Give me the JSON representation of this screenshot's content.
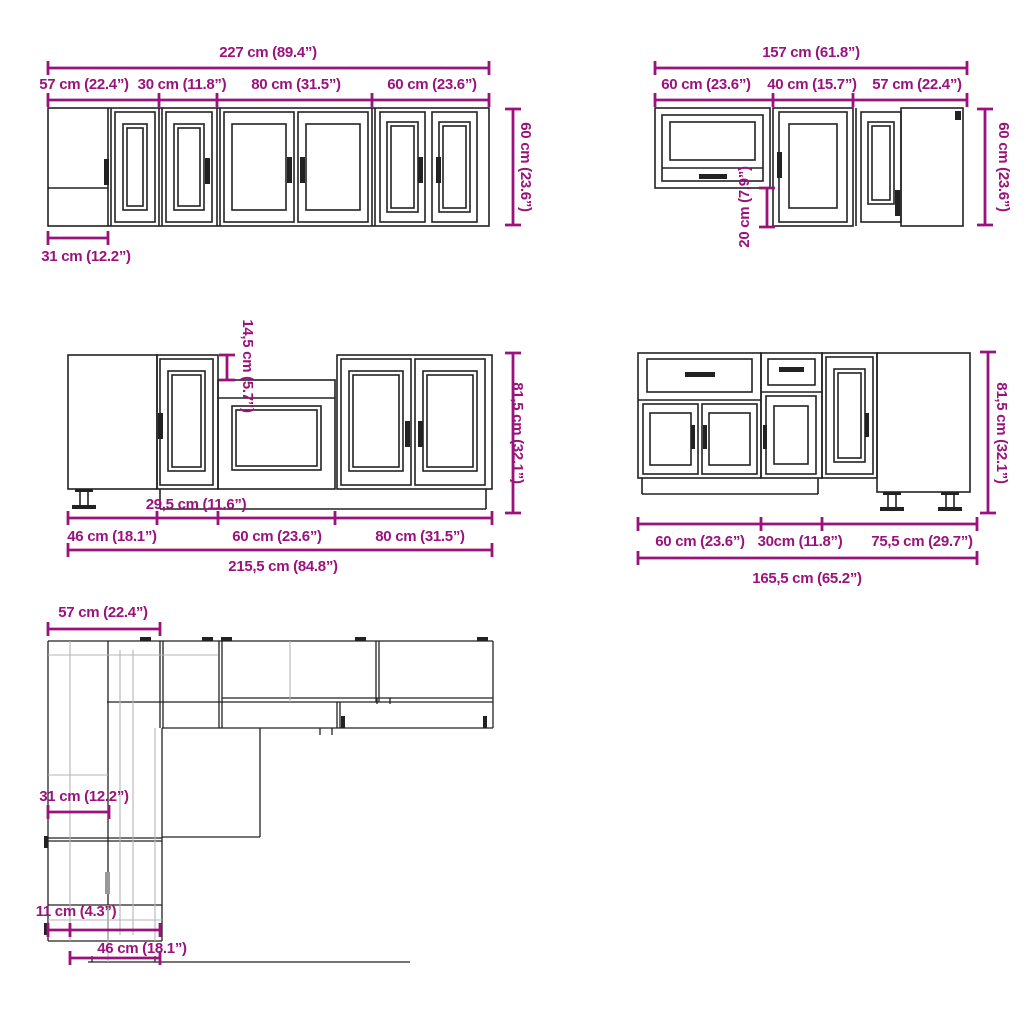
{
  "colors": {
    "dimension_accent": "#9a137c",
    "artwork_line": "#222222",
    "light_detail_line": "#b5b5b5",
    "background": "#ffffff"
  },
  "diagrams": {
    "wall_run_left": {
      "name": "upper wall cabinet run, front view",
      "total_width": "227 cm (89.4”)",
      "segments": [
        "57 cm (22.4”)",
        "30 cm (11.8”)",
        "80 cm (31.5”)",
        "60 cm (23.6”)"
      ],
      "height": "60 cm (23.6”)",
      "corner_blind_width": "31 cm (12.2”)"
    },
    "wall_run_right": {
      "name": "upper wall cabinet run with lift door, front view",
      "total_width": "157 cm (61.8”)",
      "segments": [
        "60 cm (23.6”)",
        "40 cm (15.7”)",
        "57 cm (22.4”)"
      ],
      "height": "60 cm (23.6”)",
      "bottom_offset": "20 cm (7.9”)"
    },
    "base_run_left": {
      "name": "base cabinet run with sink unit, front view",
      "sink_top_drop": "14,5 cm (5.7”)",
      "height": "81,5 cm (32.1”)",
      "narrow_door_width": "29,5 cm (11.6”)",
      "segments": [
        "46 cm (18.1”)",
        "60 cm (23.6”)",
        "80 cm (31.5”)"
      ],
      "total_width": "215,5 cm (84.8”)"
    },
    "base_run_right": {
      "name": "base cabinet run with drawers, front view",
      "height": "81,5 cm (32.1”)",
      "segments": [
        "60 cm (23.6”)",
        "30cm (11.8”)",
        "75,5 cm (29.7”)"
      ],
      "total_width": "165,5 cm (65.2”)"
    },
    "floor_plan": {
      "name": "L-shaped kitchen top view",
      "left_arm_width": "57 cm (22.4”)",
      "wall_cabinet_depth": "31 cm (12.2”)",
      "corner_filler": "11 cm (4.3”)",
      "corner_cabinet_width": "46 cm (18.1”)"
    }
  }
}
